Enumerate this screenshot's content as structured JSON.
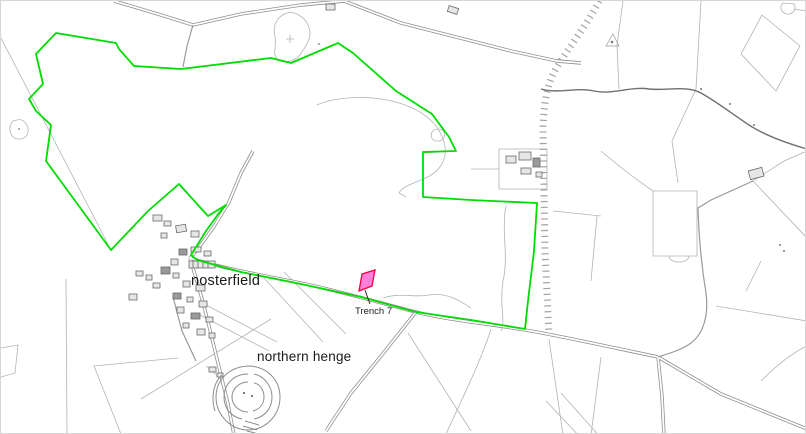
{
  "map": {
    "background": "#ffffff",
    "labels": {
      "village": "nosterfield",
      "henge": "northern henge",
      "trench": "Trench 7"
    },
    "colors": {
      "site_boundary_green": "#00dc00",
      "trench_fill_pink": "#ff7fdb",
      "trench_outline_red": "#f5003c",
      "road_casing_gray": "#8f8f8f",
      "road_infill_white": "#ffffff",
      "field_line_gray": "#b3b3b3",
      "building_outline_gray": "#6a6a6a",
      "building_fill_gray": "#e6e6e6",
      "stream_gray": "#707070",
      "hatch_gray": "#a3a3a3",
      "henge_gray": "#8d8d8d",
      "label_black": "#1a1a1a"
    }
  }
}
